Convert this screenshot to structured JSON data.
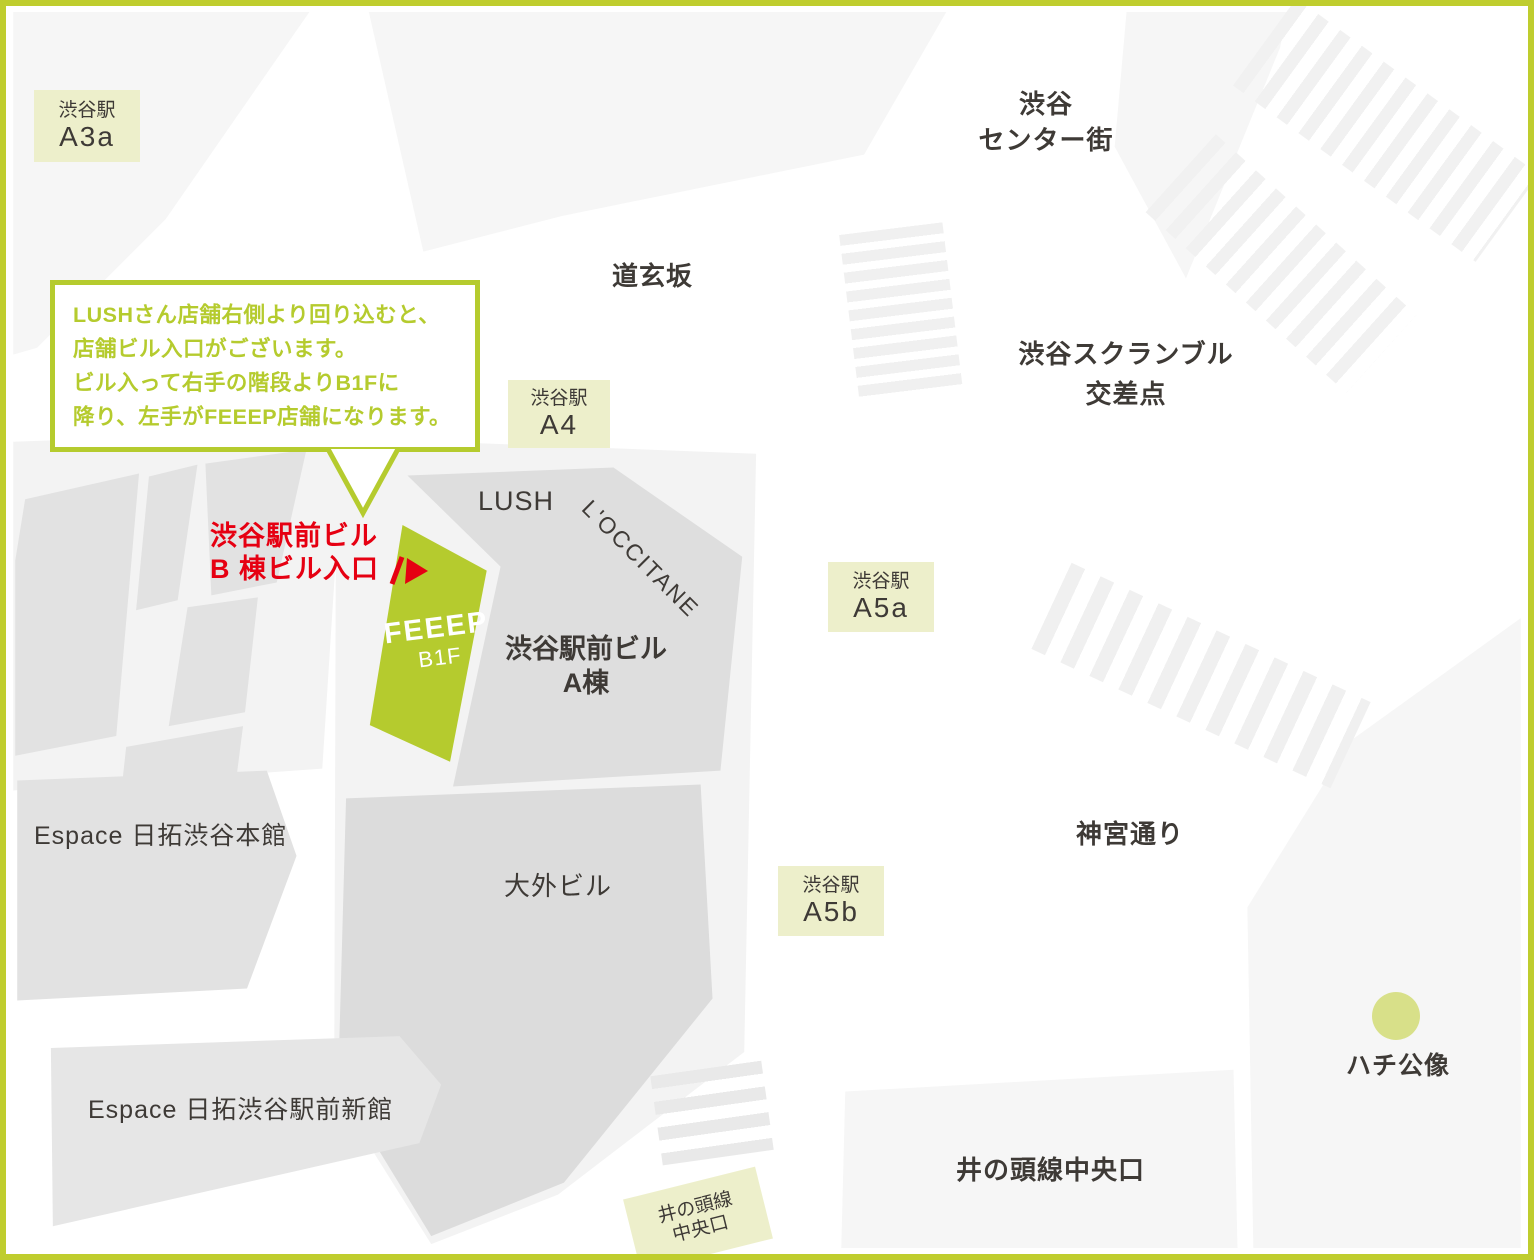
{
  "colors": {
    "accent_green": "#b5cb2e",
    "frame_green": "#bfcd2e",
    "badge_bg": "#edefcb",
    "building_gray": "#e2e2e2",
    "block_gray": "#f6f6f6",
    "hachiko_green": "#d8e089",
    "alert_red": "#e60012",
    "text_dark": "#3e3a36"
  },
  "station_badges": {
    "a3a": {
      "station": "渋谷駅",
      "exit": "A3a"
    },
    "a4": {
      "station": "渋谷駅",
      "exit": "A4"
    },
    "a5a": {
      "station": "渋谷駅",
      "exit": "A5a"
    },
    "a5b": {
      "station": "渋谷駅",
      "exit": "A5b"
    }
  },
  "inokashira_badge": {
    "line1": "井の頭線",
    "line2": "中央口"
  },
  "streets": {
    "dogenzaka": "道玄坂",
    "center_gai_line1": "渋谷",
    "center_gai_line2": "センター街",
    "scramble_line1": "渋谷スクランブル",
    "scramble_line2": "交差点",
    "jingu_dori": "神宮通り",
    "inokashira_chuo_exit": "井の頭線中央口"
  },
  "buildings": {
    "lush": "LUSH",
    "loccitane": "L'OCCITANE",
    "ekimae_a_line1": "渋谷駅前ビル",
    "ekimae_a_line2": "A棟",
    "daigai": "大外ビル",
    "espace_honkan": "Espace 日拓渋谷本館",
    "espace_shinkan": "Espace 日拓渋谷駅前新館"
  },
  "feeep": {
    "logo": "FEEEP",
    "floor": "B1F"
  },
  "entrance_label": {
    "line1": "渋谷駅前ビル",
    "line2": "B 棟ビル入口"
  },
  "callout": {
    "line1": "LUSHさん店舗右側より回り込むと、",
    "line2": "店舗ビル入口がございます。",
    "line3": "ビル入って右手の階段よりB1Fに",
    "line4": "降り、左手がFEEEP店舗になります。"
  },
  "poi": {
    "hachiko": "ハチ公像"
  }
}
